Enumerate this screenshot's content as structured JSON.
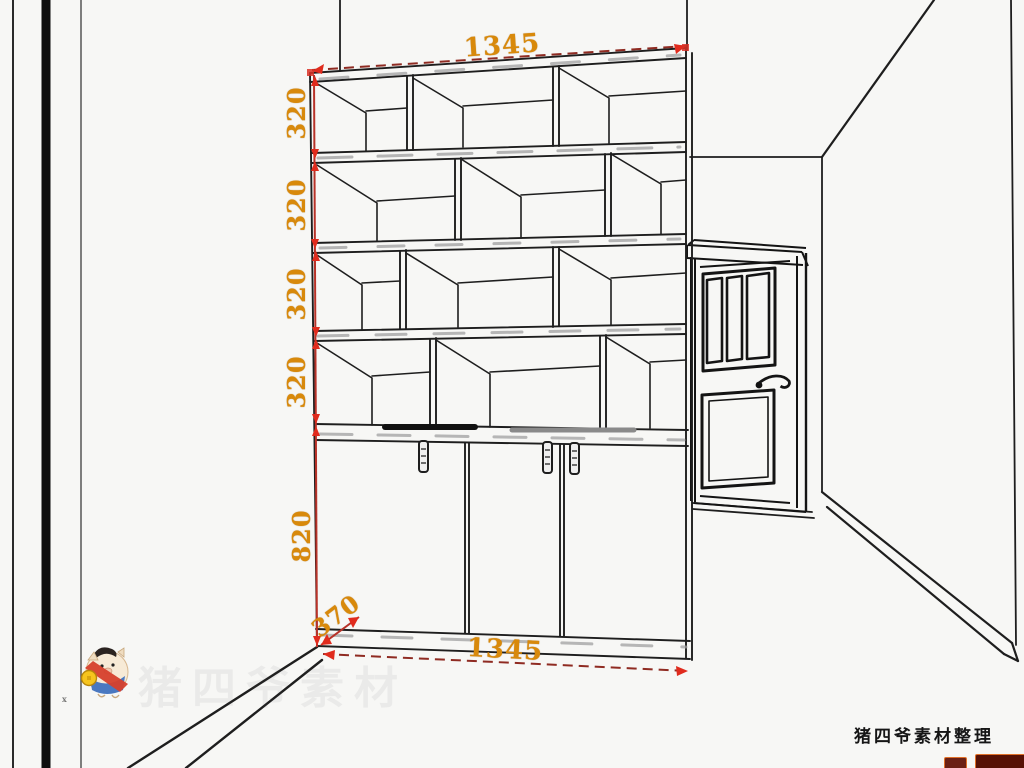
{
  "drawing": {
    "type": "furniture-perspective-diagram",
    "subject": "bookshelf-with-base-cabinet-in-room-corner",
    "dimensions": {
      "top_width": "1345",
      "shelf_heights": [
        "320",
        "320",
        "320",
        "320"
      ],
      "cabinet_height": "820",
      "base_depth": "370",
      "bottom_width": "1345"
    },
    "colors": {
      "label_orange": "#d8890b",
      "dim_line_red": "#8f2b22",
      "arrow_red": "#e02b1d",
      "line_dark": "#1e1e1e",
      "shade_gray": "#a0a0a0",
      "background": "#f7f7f5"
    },
    "counts": {
      "open_shelf_rows": 4,
      "compartments_per_row": 3,
      "cabinet_doors": 3,
      "door_glass_panes": 3
    }
  },
  "watermark": {
    "faint_text": "猪四爷素材",
    "mascot": "pig-mascot"
  },
  "credit": {
    "text": "猪四爷素材整理"
  }
}
